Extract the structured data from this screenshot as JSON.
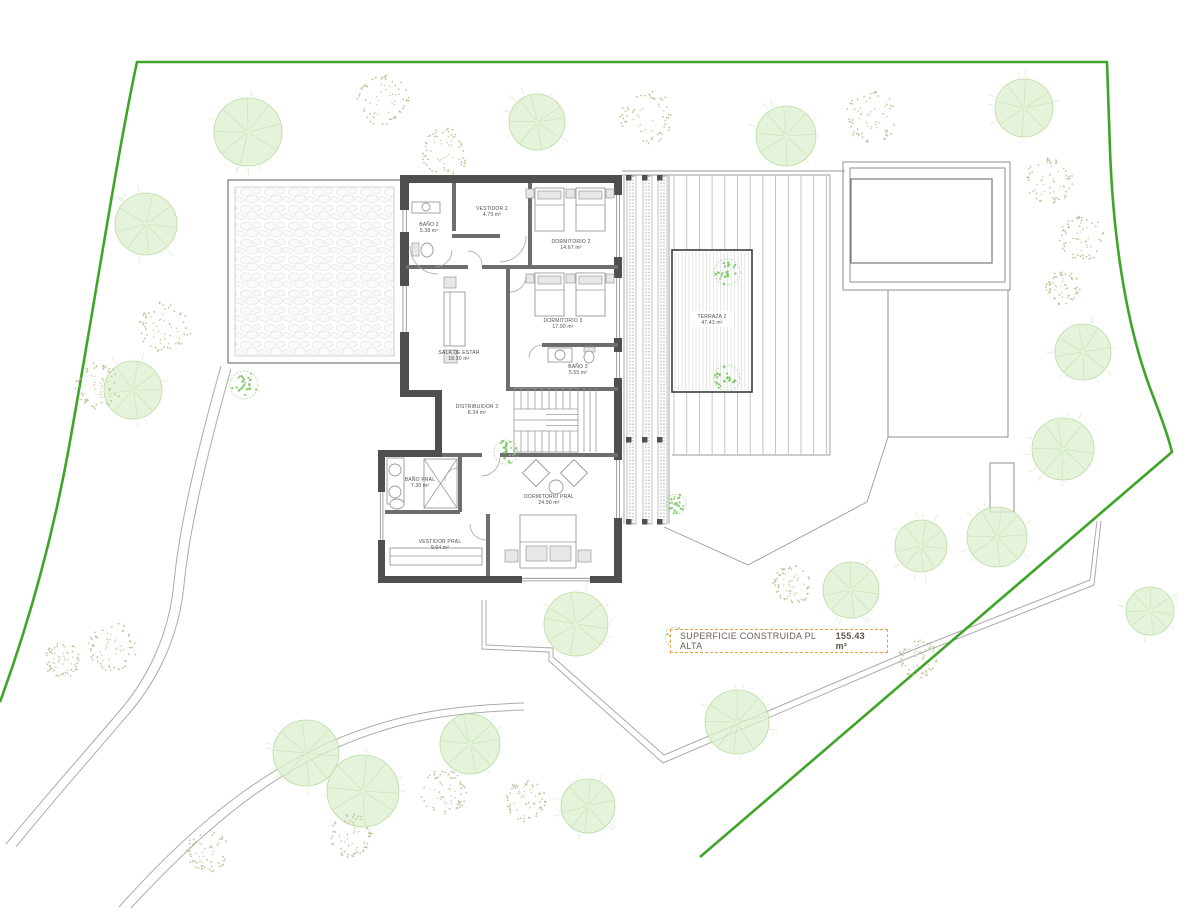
{
  "summary": {
    "label": "SUPERFICIE CONSTRUIDA PL ALTA",
    "value": "155.43 m²"
  },
  "plan": {
    "canvas": {
      "w": 1200,
      "h": 909
    },
    "colors": {
      "boundary": "#3FA529",
      "tree_fill": "#DEF0D0",
      "tree_stroke": "#B9DBA3",
      "spoke": "#C8E2B5",
      "shrub": "#B9B98C",
      "plant": "#7FC867",
      "plant_ring": "#A5CF93",
      "wall": "#4F4F4F",
      "thin_wall": "#6D6D6D",
      "furniture": "#9A9A9A",
      "deck_line": "#BDBDBD",
      "fine_line": "#D5D5D5",
      "terrace_border": "#3C3C3C",
      "path": "#ABABAB",
      "summary_border": "#E8A13C",
      "summary_text": "#6B6157"
    },
    "boundary": {
      "d": "M0,702 C30,620 55,530 72,430 C95,300 118,150 137,62 L1107,62 L1110,150 C1113,230 1124,318 1150,388 C1159,412 1167,432 1172,452 L700,857",
      "width": 2.6
    },
    "site_paths": [
      "M221,366 C200,440 180,520 174,582 C170,628 152,672 122,708 C90,746 42,800 6,844",
      "M231,369 C210,443 190,523 184,585 C180,629 162,674 132,710 C100,748 52,802 16,847",
      "M119,907 C186,832 252,776 332,741 C402,711 462,705 524,703",
      "M131,908 C196,838 258,782 336,748 C404,718 462,712 524,710",
      "M482,600 L482,649 L549,652 L549,661 L663,763 L906,659 L1094,585 L1101,521",
      "M486,600 L486,645 L553,648 L553,657 L664,755 L905,653 L1090,580 L1097,521"
    ],
    "terrace_paths": [
      "M622,171 L845,171",
      "M622,175 L830,175",
      "M830,175 L830,455",
      "M672,455 L830,455",
      "M624,176 L624,524",
      "M669,176 L669,524",
      "M664,527 L748,565 L867,502 L888,437"
    ],
    "pergola": {
      "x": 228,
      "y": 180,
      "w": 173,
      "h": 183
    },
    "pool": {
      "rects": [
        [
          843,
          162,
          167,
          128
        ],
        [
          850,
          168,
          155,
          114
        ],
        [
          851,
          179,
          141,
          84
        ],
        [
          888,
          290,
          120,
          147
        ],
        [
          990,
          463,
          24,
          49
        ]
      ]
    },
    "deck": {
      "x1": 674,
      "x2": 828,
      "y1": 176,
      "y2": 454,
      "step": 12.7,
      "terraza": {
        "x": 672,
        "y": 250,
        "w": 80,
        "h": 142,
        "fine_step": 3.5
      }
    },
    "louver": {
      "y1": 176,
      "y2": 524,
      "strips": [
        627,
        643,
        658
      ],
      "strip_w": 9,
      "post_rows": [
        175,
        437,
        519
      ]
    },
    "walls": [
      [
        400,
        175,
        222,
        8
      ],
      [
        614,
        183,
        8,
        400
      ],
      [
        400,
        183,
        9,
        207
      ],
      [
        400,
        390,
        42,
        7
      ],
      [
        435,
        397,
        7,
        56
      ],
      [
        378,
        450,
        64,
        7
      ],
      [
        378,
        457,
        7,
        126
      ],
      [
        378,
        576,
        244,
        7
      ]
    ],
    "thin_walls": [
      [
        406,
        265,
        62,
        4
      ],
      [
        482,
        265,
        136,
        4
      ],
      [
        528,
        183,
        4,
        82
      ],
      [
        452,
        183,
        4,
        48
      ],
      [
        452,
        234,
        48,
        4
      ],
      [
        506,
        269,
        4,
        121
      ],
      [
        542,
        343,
        76,
        4
      ],
      [
        506,
        387,
        112,
        4
      ],
      [
        442,
        453,
        40,
        4
      ],
      [
        500,
        453,
        118,
        4
      ],
      [
        458,
        457,
        4,
        55
      ],
      [
        385,
        510,
        75,
        4
      ],
      [
        486,
        514,
        4,
        62
      ]
    ],
    "windows": [
      [
        400,
        210,
        9,
        22
      ],
      [
        400,
        286,
        9,
        46
      ],
      [
        614,
        195,
        8,
        62
      ],
      [
        614,
        278,
        8,
        60
      ],
      [
        614,
        352,
        8,
        26
      ],
      [
        614,
        460,
        8,
        58
      ],
      [
        378,
        492,
        7,
        48
      ],
      [
        522,
        576,
        68,
        7
      ]
    ],
    "shapes": [
      {
        "t": "rect",
        "x": 535,
        "y": 188,
        "w": 29,
        "h": 43,
        "c": "furn"
      },
      {
        "t": "rect",
        "x": 538,
        "y": 191,
        "w": 23,
        "h": 8,
        "c": "furnf"
      },
      {
        "t": "line",
        "x1": 535,
        "y1": 205,
        "x2": 564,
        "y2": 205,
        "c": "tline"
      },
      {
        "t": "rect",
        "x": 576,
        "y": 188,
        "w": 29,
        "h": 43,
        "c": "furn"
      },
      {
        "t": "rect",
        "x": 579,
        "y": 191,
        "w": 23,
        "h": 8,
        "c": "furnf"
      },
      {
        "t": "line",
        "x1": 576,
        "y1": 205,
        "x2": 605,
        "y2": 205,
        "c": "tline"
      },
      {
        "t": "rect",
        "x": 526,
        "y": 189,
        "w": 8,
        "h": 9,
        "c": "furnf"
      },
      {
        "t": "rect",
        "x": 566,
        "y": 189,
        "w": 9,
        "h": 9,
        "c": "furnf"
      },
      {
        "t": "rect",
        "x": 606,
        "y": 189,
        "w": 8,
        "h": 9,
        "c": "furnf"
      },
      {
        "t": "rect",
        "x": 535,
        "y": 273,
        "w": 29,
        "h": 43,
        "c": "furn"
      },
      {
        "t": "rect",
        "x": 538,
        "y": 276,
        "w": 23,
        "h": 8,
        "c": "furnf"
      },
      {
        "t": "line",
        "x1": 535,
        "y1": 290,
        "x2": 564,
        "y2": 290,
        "c": "tline"
      },
      {
        "t": "rect",
        "x": 576,
        "y": 273,
        "w": 29,
        "h": 43,
        "c": "furn"
      },
      {
        "t": "rect",
        "x": 579,
        "y": 276,
        "w": 23,
        "h": 8,
        "c": "furnf"
      },
      {
        "t": "line",
        "x1": 576,
        "y1": 290,
        "x2": 605,
        "y2": 290,
        "c": "tline"
      },
      {
        "t": "rect",
        "x": 526,
        "y": 274,
        "w": 8,
        "h": 9,
        "c": "furnf"
      },
      {
        "t": "rect",
        "x": 566,
        "y": 274,
        "w": 9,
        "h": 9,
        "c": "furnf"
      },
      {
        "t": "rect",
        "x": 606,
        "y": 274,
        "w": 8,
        "h": 9,
        "c": "furnf"
      },
      {
        "t": "rrect",
        "cx": 536,
        "cy": 473,
        "w": 19,
        "h": 19,
        "a": 45,
        "c": "furn"
      },
      {
        "t": "rrect",
        "cx": 574,
        "cy": 473,
        "w": 19,
        "h": 19,
        "a": 45,
        "c": "furn"
      },
      {
        "t": "circle",
        "cx": 556,
        "cy": 487,
        "r": 7,
        "c": "furn"
      },
      {
        "t": "rect",
        "x": 520,
        "y": 515,
        "w": 56,
        "h": 53,
        "c": "furn"
      },
      {
        "t": "line",
        "x1": 520,
        "y1": 542,
        "x2": 576,
        "y2": 542,
        "c": "tline"
      },
      {
        "t": "rect",
        "x": 526,
        "y": 546,
        "w": 21,
        "h": 15,
        "c": "furnf"
      },
      {
        "t": "rect",
        "x": 550,
        "y": 546,
        "w": 21,
        "h": 15,
        "c": "furnf"
      },
      {
        "t": "rect",
        "x": 505,
        "y": 550,
        "w": 13,
        "h": 12,
        "c": "furnf"
      },
      {
        "t": "rect",
        "x": 578,
        "y": 550,
        "w": 13,
        "h": 12,
        "c": "furnf"
      },
      {
        "t": "rect",
        "x": 444,
        "y": 292,
        "w": 21,
        "h": 54,
        "c": "furn"
      },
      {
        "t": "line",
        "x1": 450,
        "y1": 292,
        "x2": 450,
        "y2": 346,
        "c": "tline"
      },
      {
        "t": "rect",
        "x": 444,
        "y": 277,
        "w": 12,
        "h": 11,
        "c": "furnf"
      },
      {
        "t": "rect",
        "x": 444,
        "y": 350,
        "w": 13,
        "h": 13,
        "c": "furnf"
      },
      {
        "t": "rect",
        "x": 412,
        "y": 202,
        "w": 28,
        "h": 11,
        "c": "furn"
      },
      {
        "t": "circle",
        "cx": 426,
        "cy": 207,
        "r": 4,
        "c": "furn"
      },
      {
        "t": "rect",
        "x": 412,
        "y": 243,
        "w": 7,
        "h": 13,
        "c": "furnf"
      },
      {
        "t": "ellipse",
        "cx": 427,
        "cy": 250,
        "rx": 6,
        "ry": 7,
        "c": "furn"
      },
      {
        "t": "rect",
        "x": 548,
        "y": 348,
        "w": 24,
        "h": 14,
        "c": "furn"
      },
      {
        "t": "circle",
        "cx": 560,
        "cy": 355,
        "r": 5,
        "c": "furn"
      },
      {
        "t": "rect",
        "x": 584,
        "y": 347,
        "w": 11,
        "h": 5,
        "c": "furnf"
      },
      {
        "t": "ellipse",
        "cx": 589,
        "cy": 357,
        "rx": 5,
        "ry": 6,
        "c": "furn"
      },
      {
        "t": "rect",
        "x": 387,
        "y": 458,
        "w": 17,
        "h": 46,
        "c": "furn"
      },
      {
        "t": "circle",
        "cx": 395,
        "cy": 470,
        "r": 6,
        "c": "furn"
      },
      {
        "t": "circle",
        "cx": 395,
        "cy": 492,
        "r": 6,
        "c": "furn"
      },
      {
        "t": "ellipse",
        "cx": 397,
        "cy": 504,
        "rx": 7,
        "ry": 5,
        "c": "furn"
      },
      {
        "t": "rect",
        "x": 424,
        "y": 459,
        "w": 33,
        "h": 49,
        "c": "furn"
      },
      {
        "t": "line",
        "x1": 424,
        "y1": 459,
        "x2": 457,
        "y2": 508,
        "c": "tline"
      },
      {
        "t": "line",
        "x1": 457,
        "y1": 459,
        "x2": 424,
        "y2": 508,
        "c": "tline"
      },
      {
        "t": "rect",
        "x": 390,
        "y": 548,
        "w": 92,
        "h": 17,
        "c": "furn"
      },
      {
        "t": "line",
        "x1": 390,
        "y1": 556,
        "x2": 482,
        "y2": 556,
        "c": "tline"
      },
      {
        "t": "line",
        "x1": 584,
        "y1": 388,
        "x2": 584,
        "y2": 452,
        "c": "tline"
      },
      {
        "t": "line",
        "x1": 590,
        "y1": 388,
        "x2": 590,
        "y2": 452,
        "c": "tline"
      },
      {
        "t": "line",
        "x1": 596,
        "y1": 388,
        "x2": 596,
        "y2": 452,
        "c": "tline"
      }
    ],
    "arcs": [
      "M452,250 A17,17 0 0 1 435,267",
      "M410,246 A28,28 0 0 0 438,274",
      "M526,236 A26,26 0 0 1 500,262",
      "M482,265 A14,14 0 0 0 468,251",
      "M510,292 A16,16 0 0 0 526,276",
      "M542,345 A13,13 0 0 0 529,358",
      "M500,457 A19,19 0 0 1 481,476",
      "M458,468 A13,13 0 0 0 445,481",
      "M486,540 A16,16 0 0 1 470,524"
    ],
    "stair": {
      "x": 514,
      "y": 388,
      "w": 64,
      "h": 64,
      "tread": 7
    },
    "rooms": [
      {
        "name": "BAÑO 2",
        "area": "5.38 m²",
        "x": 429,
        "y": 226
      },
      {
        "name": "VESTIDOR 2",
        "area": "4.79 m²",
        "x": 492,
        "y": 210
      },
      {
        "name": "DORMITORIO 2",
        "area": "14.67 m²",
        "x": 571,
        "y": 243
      },
      {
        "name": "DORMITORIO 3",
        "area": "17.90 m²",
        "x": 563,
        "y": 322
      },
      {
        "name": "BAÑO 3",
        "area": "5.55 m²",
        "x": 578,
        "y": 368
      },
      {
        "name": "SALA DE ESTAR",
        "area": "18.30 m²",
        "x": 459,
        "y": 354
      },
      {
        "name": "DISTRIBUIDOR 2",
        "area": "8.34 m²",
        "x": 477,
        "y": 408
      },
      {
        "name": "BAÑO PRAL",
        "area": "7.30 m²",
        "x": 420,
        "y": 481
      },
      {
        "name": "VESTIDOR PRAL",
        "area": "9.64 m²",
        "x": 440,
        "y": 543
      },
      {
        "name": "DORMITORIO PRAL",
        "area": "24.90 m²",
        "x": 549,
        "y": 498
      }
    ],
    "terraza_label": {
      "name": "TERRAZA 2",
      "area": "47.43 m²",
      "x": 712,
      "y": 318
    },
    "trees": [
      [
        248,
        132,
        34
      ],
      [
        537,
        122,
        28
      ],
      [
        786,
        136,
        30
      ],
      [
        1024,
        108,
        29
      ],
      [
        146,
        224,
        31
      ],
      [
        133,
        390,
        29
      ],
      [
        1083,
        352,
        28
      ],
      [
        1063,
        449,
        31
      ],
      [
        997,
        537,
        30
      ],
      [
        921,
        546,
        26
      ],
      [
        1150,
        611,
        24
      ],
      [
        576,
        624,
        32
      ],
      [
        851,
        590,
        28
      ],
      [
        737,
        722,
        32
      ],
      [
        470,
        744,
        30
      ],
      [
        306,
        753,
        33
      ],
      [
        363,
        791,
        36
      ],
      [
        588,
        806,
        27
      ]
    ],
    "shrubs": [
      [
        383,
        100,
        26
      ],
      [
        445,
        152,
        24
      ],
      [
        647,
        117,
        27
      ],
      [
        872,
        117,
        26
      ],
      [
        1049,
        181,
        24
      ],
      [
        1082,
        238,
        23
      ],
      [
        1063,
        288,
        17
      ],
      [
        165,
        328,
        26
      ],
      [
        98,
        386,
        23
      ],
      [
        62,
        660,
        18
      ],
      [
        112,
        646,
        25
      ],
      [
        208,
        851,
        21
      ],
      [
        351,
        836,
        22
      ],
      [
        444,
        793,
        23
      ],
      [
        525,
        801,
        21
      ],
      [
        793,
        584,
        20
      ],
      [
        918,
        658,
        20
      ]
    ],
    "plants": [
      [
        244,
        385,
        14
      ],
      [
        727,
        272,
        13
      ],
      [
        727,
        378,
        13
      ],
      [
        676,
        504,
        10
      ],
      [
        506,
        452,
        12
      ],
      [
        675,
        637,
        10
      ]
    ]
  }
}
